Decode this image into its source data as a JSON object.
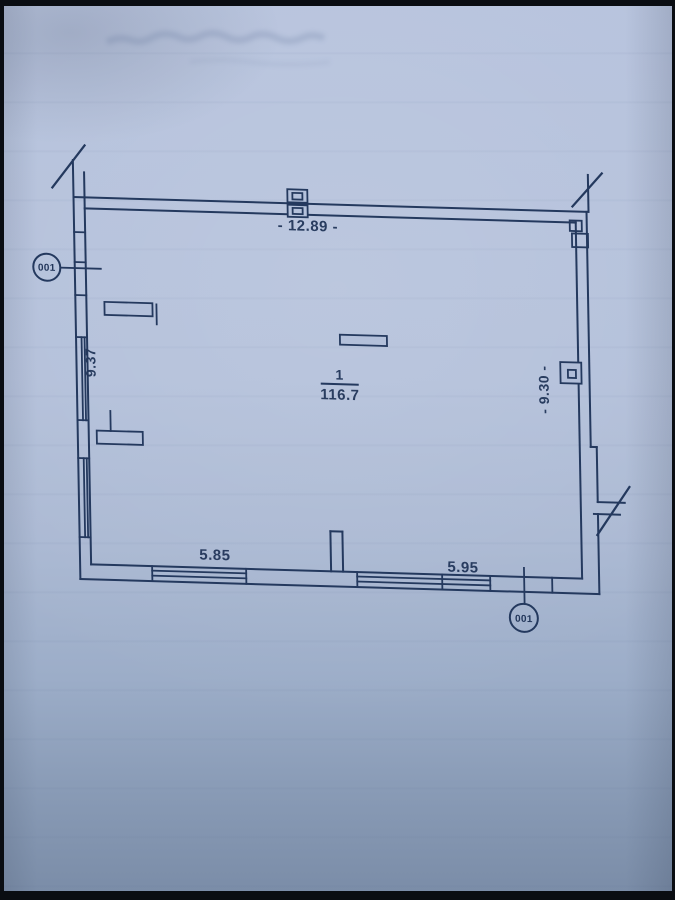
{
  "floor_plan": {
    "room": {
      "number": "1",
      "area": "116.7"
    },
    "dimensions": {
      "top": "- 12.89 -",
      "left": "9.37",
      "right": "- 9.30 -",
      "bottom_left": "5.85",
      "bottom_right": "5.95"
    },
    "section_marks": {
      "left_label": "001",
      "bottom_label": "001"
    },
    "colors": {
      "ink": "#22365a",
      "paper": "#b3c0da"
    }
  }
}
